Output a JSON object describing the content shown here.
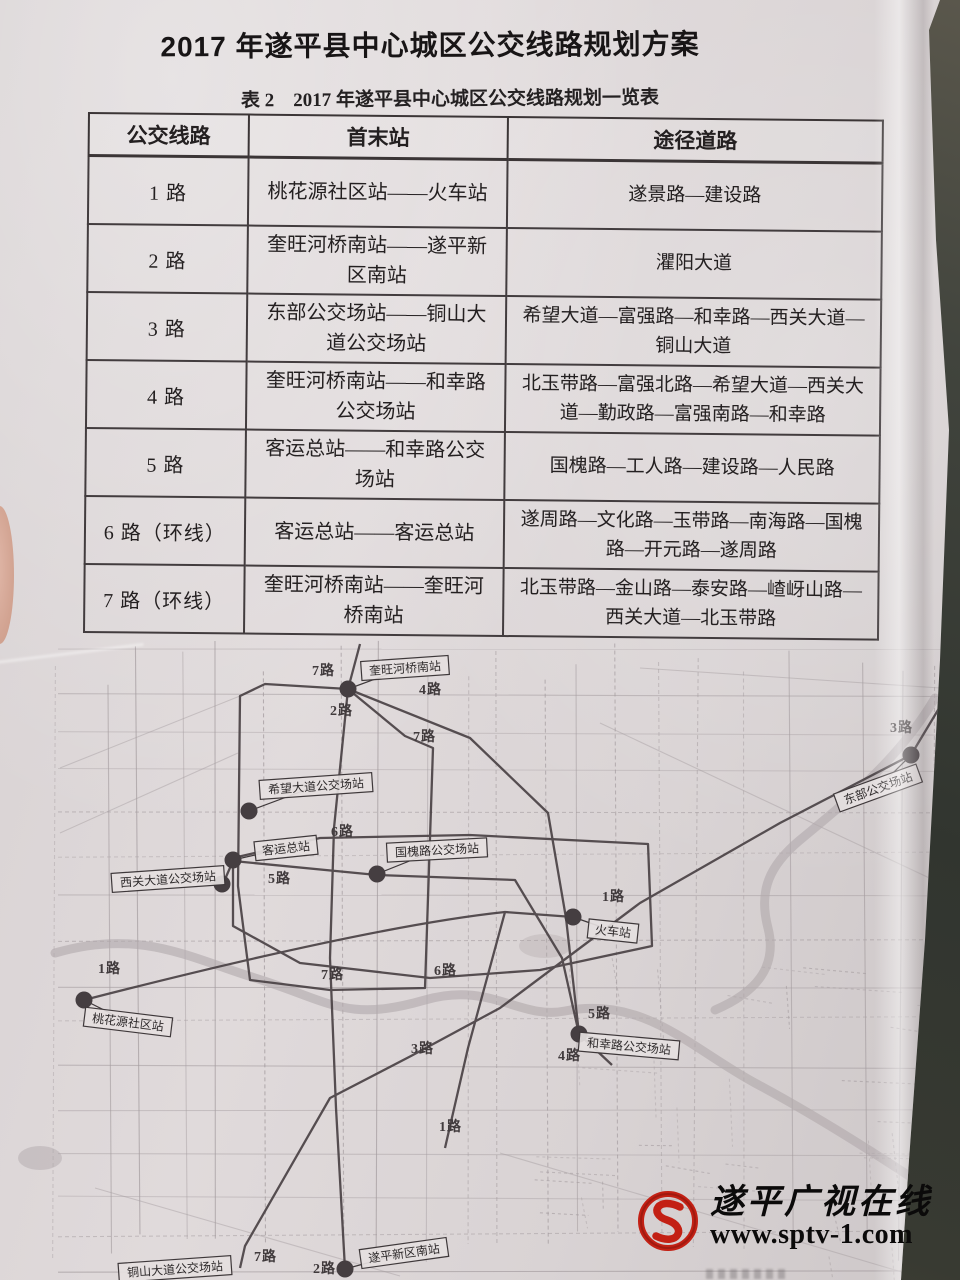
{
  "page": {
    "title": "2017 年遂平县中心城区公交线路规划方案",
    "table_caption": "表 2　2017 年遂平县中心城区公交线路规划一览表"
  },
  "table": {
    "headers": [
      "公交线路",
      "首末站",
      "途径道路"
    ],
    "rows": [
      {
        "route": "1 路",
        "terminals": "桃花源社区站——火车站",
        "roads": "遂景路—建设路"
      },
      {
        "route": "2 路",
        "terminals": "奎旺河桥南站——遂平新区南站",
        "roads": "灈阳大道"
      },
      {
        "route": "3 路",
        "terminals": "东部公交场站——铜山大道公交场站",
        "roads": "希望大道—富强路—和幸路—西关大道—铜山大道"
      },
      {
        "route": "4 路",
        "terminals": "奎旺河桥南站——和幸路公交场站",
        "roads": "北玉带路—富强北路—希望大道—西关大道—勤政路—富强南路—和幸路"
      },
      {
        "route": "5 路",
        "terminals": "客运总站——和幸路公交场站",
        "roads": "国槐路—工人路—建设路—人民路"
      },
      {
        "route": "6 路（环线）",
        "terminals": "客运总站——客运总站",
        "roads": "遂周路—文化路—玉带路—南海路—国槐路—开元路—遂周路"
      },
      {
        "route": "7 路（环线）",
        "terminals": "奎旺河桥南站——奎旺河桥南站",
        "roads": "北玉带路—金山路—泰安路—嵖岈山路—西关大道—北玉带路"
      }
    ]
  },
  "map": {
    "stations": [
      {
        "label": "奎旺河桥南站",
        "x": 405,
        "y": 40,
        "angle": -4,
        "dot": [
          348,
          61
        ]
      },
      {
        "label": "东部公交场站",
        "x": 878,
        "y": 160,
        "angle": -20,
        "dot": [
          911,
          127
        ]
      },
      {
        "label": "希望大道公交场站",
        "x": 316,
        "y": 158,
        "angle": -4,
        "dot": [
          249,
          183
        ]
      },
      {
        "label": "客运总站",
        "x": 286,
        "y": 220,
        "angle": -6,
        "dot": [
          233,
          232
        ]
      },
      {
        "label": "西关大道公交场站",
        "x": 168,
        "y": 251,
        "angle": -4,
        "dot": [
          222,
          256
        ]
      },
      {
        "label": "国槐路公交场站",
        "x": 437,
        "y": 222,
        "angle": -3,
        "dot": [
          377,
          246
        ]
      },
      {
        "label": "火车站",
        "x": 613,
        "y": 303,
        "angle": 6,
        "dot": [
          573,
          289
        ]
      },
      {
        "label": "桃花源社区站",
        "x": 128,
        "y": 394,
        "angle": 7,
        "dot": [
          84,
          372
        ]
      },
      {
        "label": "和幸路公交场站",
        "x": 629,
        "y": 418,
        "angle": 5,
        "dot": [
          579,
          406
        ]
      },
      {
        "label": "铜山大道公交场站",
        "x": 175,
        "y": 641,
        "angle": -4,
        "dot": null
      },
      {
        "label": "遂平新区南站",
        "x": 404,
        "y": 625,
        "angle": -8,
        "dot": [
          345,
          641
        ]
      }
    ],
    "route_labels": [
      {
        "t": "7路",
        "x": 312,
        "y": 47
      },
      {
        "t": "4路",
        "x": 419,
        "y": 66
      },
      {
        "t": "2路",
        "x": 330,
        "y": 87
      },
      {
        "t": "7路",
        "x": 413,
        "y": 113
      },
      {
        "t": "3路",
        "x": 890,
        "y": 104
      },
      {
        "t": "6路",
        "x": 331,
        "y": 208
      },
      {
        "t": "5路",
        "x": 268,
        "y": 255
      },
      {
        "t": "1路",
        "x": 602,
        "y": 273
      },
      {
        "t": "1路",
        "x": 98,
        "y": 345
      },
      {
        "t": "7路",
        "x": 321,
        "y": 351
      },
      {
        "t": "6路",
        "x": 434,
        "y": 347
      },
      {
        "t": "5路",
        "x": 588,
        "y": 390
      },
      {
        "t": "3路",
        "x": 411,
        "y": 425
      },
      {
        "t": "4路",
        "x": 558,
        "y": 432
      },
      {
        "t": "1路",
        "x": 439,
        "y": 503
      },
      {
        "t": "7路",
        "x": 254,
        "y": 633
      },
      {
        "t": "2路",
        "x": 313,
        "y": 645
      }
    ]
  },
  "watermark": {
    "name": "遂平广视在线",
    "url": "www.sptv-1.com"
  }
}
